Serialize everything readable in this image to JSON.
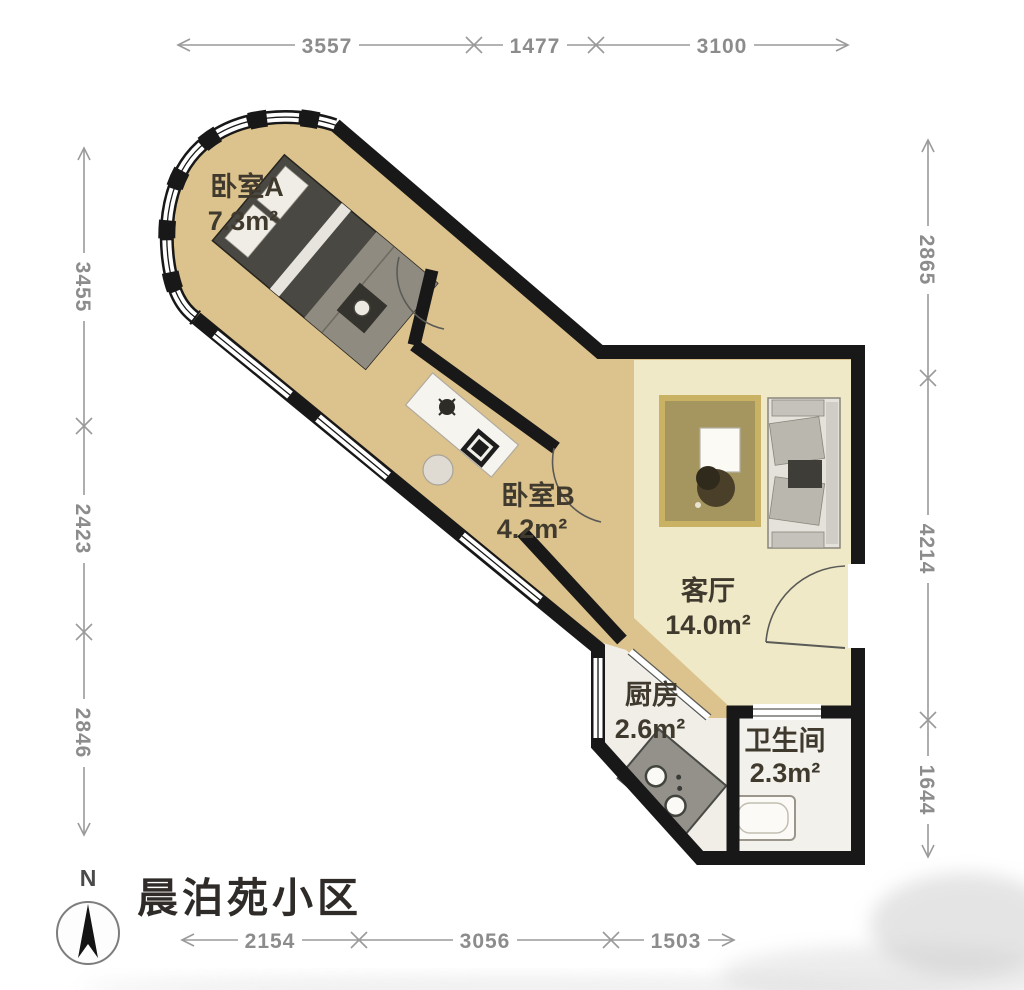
{
  "title": "晨泊苑小区",
  "compass": {
    "label": "N"
  },
  "dimensions": {
    "top": [
      "3557",
      "1477",
      "3100"
    ],
    "bottom": [
      "2154",
      "3056",
      "1503"
    ],
    "left": [
      "3455",
      "2423",
      "2846"
    ],
    "right": [
      "2865",
      "4214",
      "1644"
    ]
  },
  "rooms": {
    "bedroomA": {
      "name": "卧室A",
      "area": "7.3m²"
    },
    "bedroomB": {
      "name": "卧室B",
      "area": "4.2m²"
    },
    "living": {
      "name": "客厅",
      "area": "14.0m²"
    },
    "kitchen": {
      "name": "厨房",
      "area": "2.6m²"
    },
    "bath": {
      "name": "卫生间",
      "area": "2.3m²"
    }
  },
  "colors": {
    "wall": "#181818",
    "floor_bedroom": "#dcc28c",
    "floor_living": "#efe9c7",
    "floor_kitchen": "#f0eee7",
    "floor_bath": "#f2f1ec",
    "dimension_gray": "#8c8c8c"
  }
}
